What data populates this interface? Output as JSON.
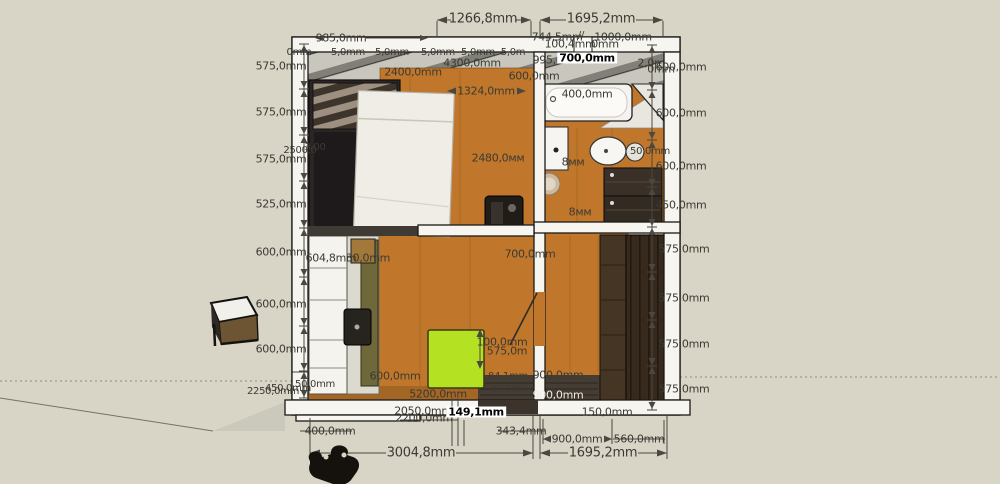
{
  "scene": {
    "app": "3d-model-viewport",
    "view": "apartment-floor-plan-top-view",
    "units": "mm"
  },
  "colors": {
    "bg": "#d8d4c6",
    "wall": "#f6f5f0",
    "outline": "#1b1a17",
    "floor": "#c0772b",
    "subfloor": "#c9c6be",
    "green": "#b4e223",
    "sofa": "#2b2526",
    "bed": "#efede6",
    "wardrobe": "#372a1d",
    "appliance": "#352b21",
    "olive": "#6f683a",
    "label": "#3b3a33",
    "dotted": "#8e8b80"
  },
  "objects": [
    "bathtub",
    "shower-screen",
    "sink",
    "mirror",
    "toilet",
    "cistern",
    "round-rug",
    "washer-dryer-stack",
    "wardrobe",
    "sofa",
    "bed",
    "dark-cabinet",
    "kitchen-cabinets",
    "kitchen-sink",
    "kitchen-tall-cabinet",
    "green-table",
    "door-leaf",
    "stool",
    "person-figure"
  ],
  "labels": [
    {
      "t": "1266,8mm",
      "x": 483,
      "y": 19,
      "s": 13
    },
    {
      "t": "1695,2mm",
      "x": 601,
      "y": 19,
      "s": 13
    },
    {
      "t": "985,0mm",
      "x": 341,
      "y": 38
    },
    {
      "t": "744,5mm",
      "x": 557,
      "y": 37
    },
    {
      "t": "//",
      "x": 581,
      "y": 36,
      "s": 10
    },
    {
      "t": "1000,0mm",
      "x": 623,
      "y": 37
    },
    {
      "t": "100,4mm",
      "x": 570,
      "y": 44
    },
    {
      "t": "0mm",
      "x": 605,
      "y": 44
    },
    {
      "t": "0mm",
      "x": 299,
      "y": 53,
      "s": 10
    },
    {
      "t": "5,0mm",
      "x": 348,
      "y": 53,
      "s": 10
    },
    {
      "t": "5,0mm",
      "x": 392,
      "y": 53,
      "s": 10
    },
    {
      "t": "5,0mm",
      "x": 438,
      "y": 53,
      "s": 10
    },
    {
      "t": "5,0mm",
      "x": 478,
      "y": 53,
      "s": 10
    },
    {
      "t": "5,0m",
      "x": 513,
      "y": 53,
      "s": 10
    },
    {
      "t": "995,0mm",
      "x": 558,
      "y": 60
    },
    {
      "t": "700,0mm",
      "x": 587,
      "y": 58,
      "c": "hl"
    },
    {
      "t": "2,0m",
      "x": 651,
      "y": 63,
      "s": 11
    },
    {
      "t": "0mm",
      "x": 661,
      "y": 69,
      "s": 11
    },
    {
      "t": "600,0mm",
      "x": 681,
      "y": 67
    },
    {
      "t": "600,0mm",
      "x": 681,
      "y": 113
    },
    {
      "t": "600,0mm",
      "x": 681,
      "y": 166
    },
    {
      "t": "450,0mm",
      "x": 681,
      "y": 205
    },
    {
      "t": "50,0mm",
      "x": 650,
      "y": 152,
      "s": 10
    },
    {
      "t": "575,0mm",
      "x": 684,
      "y": 249
    },
    {
      "t": "575,0mm",
      "x": 684,
      "y": 298
    },
    {
      "t": "575,0mm",
      "x": 684,
      "y": 344
    },
    {
      "t": "575,0mm",
      "x": 684,
      "y": 389
    },
    {
      "t": "575,0mm",
      "x": 281,
      "y": 66
    },
    {
      "t": "575,0mm",
      "x": 281,
      "y": 112
    },
    {
      "t": "575,0mm",
      "x": 281,
      "y": 159
    },
    {
      "t": "525,0mm",
      "x": 281,
      "y": 204
    },
    {
      "t": "600,0mm",
      "x": 281,
      "y": 252
    },
    {
      "t": "600,0mm",
      "x": 281,
      "y": 304
    },
    {
      "t": "600,0mm",
      "x": 281,
      "y": 349
    },
    {
      "t": "2500,0",
      "x": 300,
      "y": 151,
      "s": 10
    },
    {
      "t": "3,00",
      "x": 315,
      "y": 148,
      "s": 10
    },
    {
      "t": "2250,0mm",
      "x": 273,
      "y": 392,
      "s": 10
    },
    {
      "t": "450,0mm",
      "x": 288,
      "y": 389,
      "s": 10
    },
    {
      "t": "50,0mm",
      "x": 315,
      "y": 385,
      "s": 10
    },
    {
      "t": "2400,0mm",
      "x": 413,
      "y": 72
    },
    {
      "t": "4300,0mm",
      "x": 472,
      "y": 63
    },
    {
      "t": "600,0mm",
      "x": 534,
      "y": 76,
      "s": 11
    },
    {
      "t": "1324,0mm",
      "x": 486,
      "y": 91
    },
    {
      "t": "400,0mm",
      "x": 587,
      "y": 94
    },
    {
      "t": "2480,0мм",
      "x": 498,
      "y": 158
    },
    {
      "t": "8мм",
      "x": 573,
      "y": 162
    },
    {
      "t": "8мм",
      "x": 580,
      "y": 212
    },
    {
      "t": "700,0mm",
      "x": 530,
      "y": 254
    },
    {
      "t": "604,8mm",
      "x": 331,
      "y": 258,
      "s": 11
    },
    {
      "t": "30,0mm",
      "x": 368,
      "y": 258,
      "s": 11
    },
    {
      "t": "100,0mm",
      "x": 502,
      "y": 342
    },
    {
      "t": "575,0m",
      "x": 507,
      "y": 351
    },
    {
      "t": "600,0mm",
      "x": 395,
      "y": 376,
      "s": 11
    },
    {
      "t": "900,0mm",
      "x": 558,
      "y": 375,
      "s": 11
    },
    {
      "t": "84,1mm",
      "x": 508,
      "y": 377,
      "s": 10
    },
    {
      "t": "47,10m",
      "x": 509,
      "y": 390,
      "s": 10
    },
    {
      "t": "900,0mm",
      "x": 558,
      "y": 395,
      "s": 11,
      "c": "wt"
    },
    {
      "t": "5200,0mm",
      "x": 438,
      "y": 394
    },
    {
      "t": "2050,0mm",
      "x": 423,
      "y": 411,
      "s": 11
    },
    {
      "t": "2200,0mm",
      "x": 424,
      "y": 418,
      "s": 11
    },
    {
      "t": "149,1mm",
      "x": 476,
      "y": 412,
      "s": 11,
      "c": "hl"
    },
    {
      "t": "150,0mm",
      "x": 607,
      "y": 412
    },
    {
      "t": "343,4mm",
      "x": 521,
      "y": 431
    },
    {
      "t": "400,0mm",
      "x": 330,
      "y": 431
    },
    {
      "t": "900,0mm",
      "x": 577,
      "y": 439
    },
    {
      "t": "560,0mm",
      "x": 639,
      "y": 439
    },
    {
      "t": "3004,8mm",
      "x": 421,
      "y": 453,
      "s": 13
    },
    {
      "t": "1695,2mm",
      "x": 603,
      "y": 453,
      "s": 13
    }
  ]
}
